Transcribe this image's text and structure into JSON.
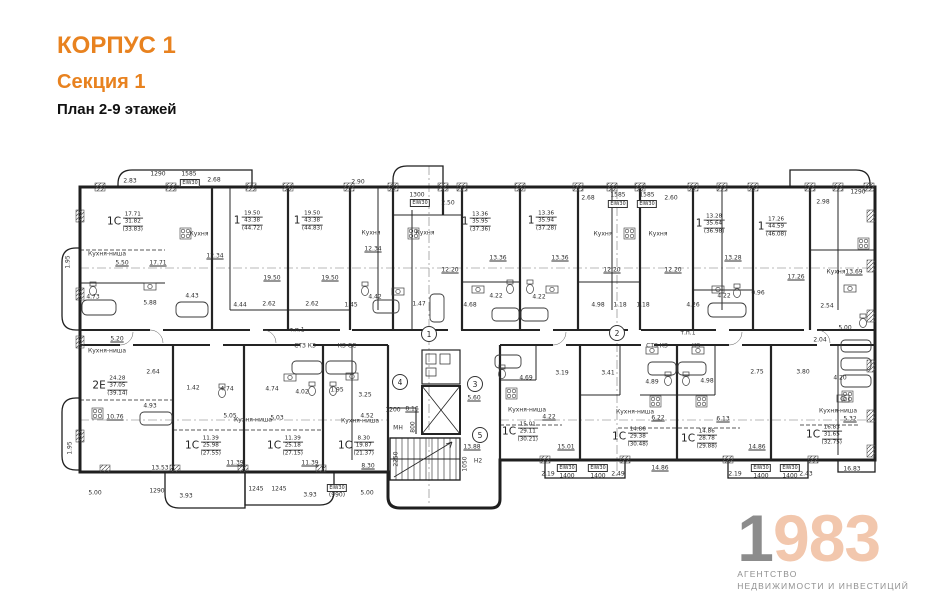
{
  "header": {
    "korpus": "КОРПУС 1",
    "sekcia": "Секция 1",
    "plan": "План 2-9 этажей"
  },
  "logo": {
    "year_first": "1",
    "year_rest": "983",
    "tagline_line1": "АГЕНТСТВО",
    "tagline_line2": "НЕДВИЖИМОСТИ И ИНВЕСТИЦИЙ"
  },
  "colors": {
    "accent_orange": "#E8821F",
    "logo_gray": "#8C8C8C",
    "logo_peach": "#F2C7AD",
    "line_dark": "#222222"
  },
  "plan": {
    "apartments": [
      {
        "t": "1С",
        "n1": "17.71",
        "n2": "31.82",
        "n3": "(33.83)",
        "x": 125,
        "y": 222
      },
      {
        "t": "1",
        "n1": "19.50",
        "n2": "43.38",
        "n3": "(44.72)",
        "x": 248,
        "y": 221
      },
      {
        "t": "1",
        "n1": "19.50",
        "n2": "43.38",
        "n3": "(44.83)",
        "x": 308,
        "y": 221
      },
      {
        "t": "1",
        "n1": "13.36",
        "n2": "35.95",
        "n3": "(37.36)",
        "x": 476,
        "y": 222
      },
      {
        "t": "1",
        "n1": "13.36",
        "n2": "35.94",
        "n3": "(37.28)",
        "x": 542,
        "y": 221
      },
      {
        "t": "1",
        "n1": "13.28",
        "n2": "35.64",
        "n3": "(36.98)",
        "x": 710,
        "y": 224
      },
      {
        "t": "1",
        "n1": "17.26",
        "n2": "44.59",
        "n3": "(46.08)",
        "x": 772,
        "y": 227
      },
      {
        "t": "2Е",
        "n1": "24.28",
        "n2": "37.05",
        "n3": "(39.14)",
        "x": 110,
        "y": 386
      },
      {
        "t": "1С",
        "n1": "11.39",
        "n2": "25.98",
        "n3": "(27.55)",
        "x": 203,
        "y": 446
      },
      {
        "t": "1С",
        "n1": "11.39",
        "n2": "25.18",
        "n3": "(27.15)",
        "x": 285,
        "y": 446
      },
      {
        "t": "1С",
        "n1": "8.30",
        "n2": "19.87",
        "n3": "(21.37)",
        "x": 356,
        "y": 446
      },
      {
        "t": "1С",
        "n1": "15.01",
        "n2": "29.11",
        "n3": "(30.21)",
        "x": 520,
        "y": 432
      },
      {
        "t": "1С",
        "n1": "14.86",
        "n2": "29.38",
        "n3": "(30.48)",
        "x": 630,
        "y": 437
      },
      {
        "t": "1С",
        "n1": "14.86",
        "n2": "28.78",
        "n3": "(29.88)",
        "x": 699,
        "y": 439
      },
      {
        "t": "1С",
        "n1": "16.83",
        "n2": "31.65",
        "n3": "(32.75)",
        "x": 824,
        "y": 435
      }
    ],
    "rooms": [
      {
        "t": "Кухня-ниша",
        "x": 107,
        "y": 254
      },
      {
        "t": "Кухня",
        "x": 199,
        "y": 234
      },
      {
        "t": "Кухня",
        "x": 371,
        "y": 233
      },
      {
        "t": "Кухня",
        "x": 425,
        "y": 233
      },
      {
        "t": "Кухня",
        "x": 603,
        "y": 234
      },
      {
        "t": "Кухня",
        "x": 658,
        "y": 234
      },
      {
        "t": "Кухня",
        "x": 836,
        "y": 272
      },
      {
        "t": "Кухня-ниша",
        "x": 107,
        "y": 351
      },
      {
        "t": "Кухня-ниша",
        "x": 253,
        "y": 420
      },
      {
        "t": "Кухня-ниша",
        "x": 360,
        "y": 421
      },
      {
        "t": "Кухня-ниша",
        "x": 527,
        "y": 410
      },
      {
        "t": "Кухня-ниша",
        "x": 635,
        "y": 412
      },
      {
        "t": "Кухня-ниша",
        "x": 838,
        "y": 411
      },
      {
        "t": "МН",
        "x": 398,
        "y": 428
      },
      {
        "t": "СТЗ КЗ",
        "x": 305,
        "y": 346
      },
      {
        "t": "КЗ СС",
        "x": 347,
        "y": 346
      },
      {
        "t": "СТЗ КЗ",
        "x": 657,
        "y": 346
      },
      {
        "t": "КЗ",
        "x": 696,
        "y": 346
      },
      {
        "t": "т.п.1",
        "x": 297,
        "y": 330
      },
      {
        "t": "т.п.1",
        "x": 688,
        "y": 333
      },
      {
        "t": "Н2",
        "x": 478,
        "y": 461
      }
    ],
    "dims": [
      {
        "t": "2.83",
        "x": 130,
        "y": 181
      },
      {
        "t": "1290",
        "x": 158,
        "y": 174
      },
      {
        "t": "1585",
        "x": 189,
        "y": 174
      },
      {
        "t": "2.68",
        "x": 214,
        "y": 180
      },
      {
        "t": "2.90",
        "x": 358,
        "y": 182
      },
      {
        "t": "1300",
        "x": 417,
        "y": 195
      },
      {
        "t": "2.50",
        "x": 448,
        "y": 203
      },
      {
        "t": "2.68",
        "x": 588,
        "y": 198
      },
      {
        "t": "1585",
        "x": 618,
        "y": 195
      },
      {
        "t": "1585",
        "x": 647,
        "y": 195
      },
      {
        "t": "2.60",
        "x": 671,
        "y": 198
      },
      {
        "t": "2.98",
        "x": 823,
        "y": 202
      },
      {
        "t": "1290",
        "x": 858,
        "y": 192
      },
      {
        "t": "5.50",
        "x": 122,
        "y": 263,
        "u": 1
      },
      {
        "t": "17.71",
        "x": 158,
        "y": 263,
        "u": 1
      },
      {
        "t": "12.34",
        "x": 215,
        "y": 256,
        "u": 1
      },
      {
        "t": "19.50",
        "x": 272,
        "y": 278,
        "u": 1
      },
      {
        "t": "19.50",
        "x": 330,
        "y": 278,
        "u": 1
      },
      {
        "t": "12.34",
        "x": 373,
        "y": 249,
        "u": 1
      },
      {
        "t": "12.20",
        "x": 450,
        "y": 270,
        "u": 1
      },
      {
        "t": "13.36",
        "x": 498,
        "y": 258,
        "u": 1
      },
      {
        "t": "13.36",
        "x": 560,
        "y": 258,
        "u": 1
      },
      {
        "t": "12.20",
        "x": 612,
        "y": 270,
        "u": 1
      },
      {
        "t": "12.20",
        "x": 673,
        "y": 270,
        "u": 1
      },
      {
        "t": "13.28",
        "x": 733,
        "y": 258,
        "u": 1
      },
      {
        "t": "17.26",
        "x": 796,
        "y": 277,
        "u": 1
      },
      {
        "t": "13.69",
        "x": 854,
        "y": 272,
        "u": 1
      },
      {
        "t": "4.73",
        "x": 93,
        "y": 297
      },
      {
        "t": "5.88",
        "x": 150,
        "y": 303
      },
      {
        "t": "4.43",
        "x": 192,
        "y": 296
      },
      {
        "t": "4.44",
        "x": 240,
        "y": 305
      },
      {
        "t": "2.62",
        "x": 269,
        "y": 304
      },
      {
        "t": "2.62",
        "x": 312,
        "y": 304
      },
      {
        "t": "1.45",
        "x": 351,
        "y": 305
      },
      {
        "t": "4.42",
        "x": 375,
        "y": 297
      },
      {
        "t": "1.47",
        "x": 419,
        "y": 304
      },
      {
        "t": "4.68",
        "x": 470,
        "y": 305
      },
      {
        "t": "4.22",
        "x": 496,
        "y": 296
      },
      {
        "t": "4.22",
        "x": 539,
        "y": 297
      },
      {
        "t": "4.98",
        "x": 598,
        "y": 305
      },
      {
        "t": "1.18",
        "x": 620,
        "y": 305
      },
      {
        "t": "1.18",
        "x": 643,
        "y": 305
      },
      {
        "t": "4.26",
        "x": 693,
        "y": 305
      },
      {
        "t": "4.22",
        "x": 724,
        "y": 296
      },
      {
        "t": "0.96",
        "x": 758,
        "y": 293
      },
      {
        "t": "2.54",
        "x": 827,
        "y": 306
      },
      {
        "t": "5.00",
        "x": 845,
        "y": 328
      },
      {
        "t": "2.04",
        "x": 820,
        "y": 340
      },
      {
        "t": "2.75",
        "x": 757,
        "y": 372
      },
      {
        "t": "3.80",
        "x": 803,
        "y": 372
      },
      {
        "t": "4.20",
        "x": 840,
        "y": 378
      },
      {
        "t": "5.32",
        "x": 850,
        "y": 419,
        "u": 1
      },
      {
        "t": "1.95",
        "x": 68,
        "y": 262,
        "r": 1
      },
      {
        "t": "1.95",
        "x": 70,
        "y": 448,
        "r": 1
      },
      {
        "t": "5.20",
        "x": 117,
        "y": 339,
        "u": 1
      },
      {
        "t": "2.64",
        "x": 153,
        "y": 372
      },
      {
        "t": "1.42",
        "x": 193,
        "y": 388
      },
      {
        "t": "4.93",
        "x": 150,
        "y": 406
      },
      {
        "t": "10.76",
        "x": 115,
        "y": 417,
        "u": 1
      },
      {
        "t": "13.53",
        "x": 160,
        "y": 468,
        "u": 1
      },
      {
        "t": "4.74",
        "x": 227,
        "y": 389
      },
      {
        "t": "4.74",
        "x": 272,
        "y": 389
      },
      {
        "t": "4.02",
        "x": 302,
        "y": 392
      },
      {
        "t": "1.95",
        "x": 337,
        "y": 390
      },
      {
        "t": "3.25",
        "x": 365,
        "y": 395
      },
      {
        "t": "5.05",
        "x": 230,
        "y": 416
      },
      {
        "t": "5.03",
        "x": 277,
        "y": 418
      },
      {
        "t": "4.52",
        "x": 367,
        "y": 416
      },
      {
        "t": "1200",
        "x": 393,
        "y": 410
      },
      {
        "t": "8.16",
        "x": 412,
        "y": 409,
        "u": 1
      },
      {
        "t": "800",
        "x": 413,
        "y": 427,
        "r": 1
      },
      {
        "t": "11.39",
        "x": 235,
        "y": 463,
        "u": 1
      },
      {
        "t": "11.39",
        "x": 310,
        "y": 463,
        "u": 1
      },
      {
        "t": "8.30",
        "x": 368,
        "y": 466,
        "u": 1
      },
      {
        "t": "5.60",
        "x": 474,
        "y": 398,
        "u": 1
      },
      {
        "t": "13.88",
        "x": 472,
        "y": 447,
        "u": 1
      },
      {
        "t": "1050",
        "x": 465,
        "y": 464,
        "r": 1
      },
      {
        "t": "2250",
        "x": 396,
        "y": 459,
        "r": 1
      },
      {
        "t": "4.69",
        "x": 526,
        "y": 378
      },
      {
        "t": "3.19",
        "x": 562,
        "y": 373
      },
      {
        "t": "3.41",
        "x": 608,
        "y": 373
      },
      {
        "t": "4.89",
        "x": 652,
        "y": 382
      },
      {
        "t": "4.98",
        "x": 707,
        "y": 381
      },
      {
        "t": "6.22",
        "x": 658,
        "y": 418,
        "u": 1
      },
      {
        "t": "6.13",
        "x": 723,
        "y": 419,
        "u": 1
      },
      {
        "t": "4.22",
        "x": 549,
        "y": 417,
        "u": 1
      },
      {
        "t": "15.01",
        "x": 566,
        "y": 447,
        "u": 1
      },
      {
        "t": "14.86",
        "x": 660,
        "y": 468,
        "u": 1
      },
      {
        "t": "14.86",
        "x": 757,
        "y": 447,
        "u": 1
      },
      {
        "t": "16.83",
        "x": 852,
        "y": 469,
        "u": 1
      },
      {
        "t": "2.19",
        "x": 548,
        "y": 474
      },
      {
        "t": "2.49",
        "x": 618,
        "y": 474
      },
      {
        "t": "2.19",
        "x": 735,
        "y": 474
      },
      {
        "t": "2.43",
        "x": 806,
        "y": 474
      },
      {
        "t": "1400",
        "x": 567,
        "y": 476
      },
      {
        "t": "1400",
        "x": 598,
        "y": 476
      },
      {
        "t": "1400",
        "x": 761,
        "y": 476
      },
      {
        "t": "1400",
        "x": 790,
        "y": 476
      },
      {
        "t": "5.00",
        "x": 95,
        "y": 493
      },
      {
        "t": "1290",
        "x": 157,
        "y": 491
      },
      {
        "t": "3.93",
        "x": 186,
        "y": 496
      },
      {
        "t": "1245",
        "x": 256,
        "y": 489
      },
      {
        "t": "1245",
        "x": 279,
        "y": 489
      },
      {
        "t": "3.93",
        "x": 310,
        "y": 495
      },
      {
        "t": "(990)",
        "x": 337,
        "y": 495
      },
      {
        "t": "5.00",
        "x": 367,
        "y": 493
      }
    ],
    "axes": [
      {
        "n": "1",
        "x": 429,
        "y": 334
      },
      {
        "n": "2",
        "x": 617,
        "y": 333
      },
      {
        "n": "3",
        "x": 475,
        "y": 384
      },
      {
        "n": "4",
        "x": 400,
        "y": 382
      },
      {
        "n": "5",
        "x": 480,
        "y": 435
      }
    ],
    "fire_boxes": [
      {
        "t": "EIW30",
        "x": 190,
        "y": 183
      },
      {
        "t": "EIW30",
        "x": 420,
        "y": 203
      },
      {
        "t": "EIW30",
        "x": 618,
        "y": 204
      },
      {
        "t": "EIW30",
        "x": 647,
        "y": 204
      },
      {
        "t": "EIW30",
        "x": 567,
        "y": 468
      },
      {
        "t": "EIW30",
        "x": 598,
        "y": 468
      },
      {
        "t": "EIW30",
        "x": 761,
        "y": 468
      },
      {
        "t": "EIW30",
        "x": 790,
        "y": 468
      },
      {
        "t": "EIW30",
        "x": 337,
        "y": 488
      }
    ]
  }
}
